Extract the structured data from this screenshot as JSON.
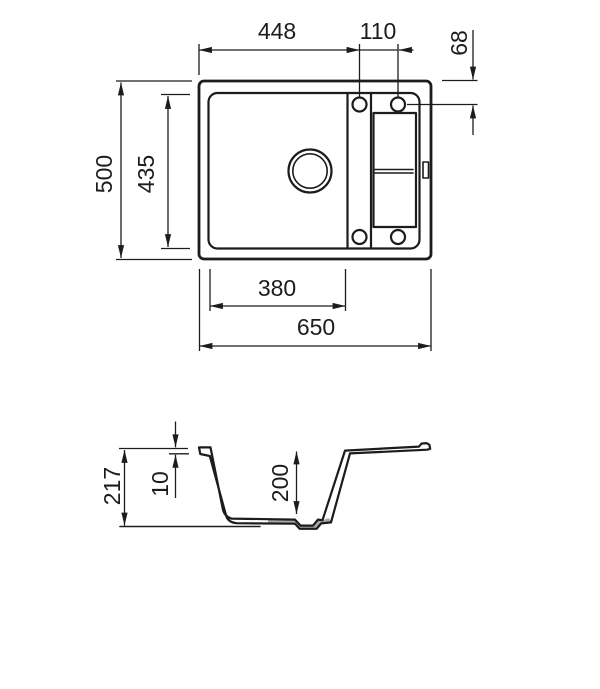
{
  "page": {
    "background": "#ffffff",
    "description": "technical dimension drawing of kitchen sink, top view and cross-section view"
  },
  "colors": {
    "line": "#1c1c1c",
    "shade": "#a9a9a9"
  },
  "dimensions": {
    "top_width_to_first_hole": "448",
    "hole_spacing": "110",
    "hole_center_from_top_edge": "68",
    "overall_depth_front_to_back": "500",
    "bowl_length_front_to_back": "435",
    "bowl_width": "380",
    "overall_width": "650",
    "total_height": "217",
    "rim_height": "10",
    "bowl_inner_depth": "200"
  }
}
